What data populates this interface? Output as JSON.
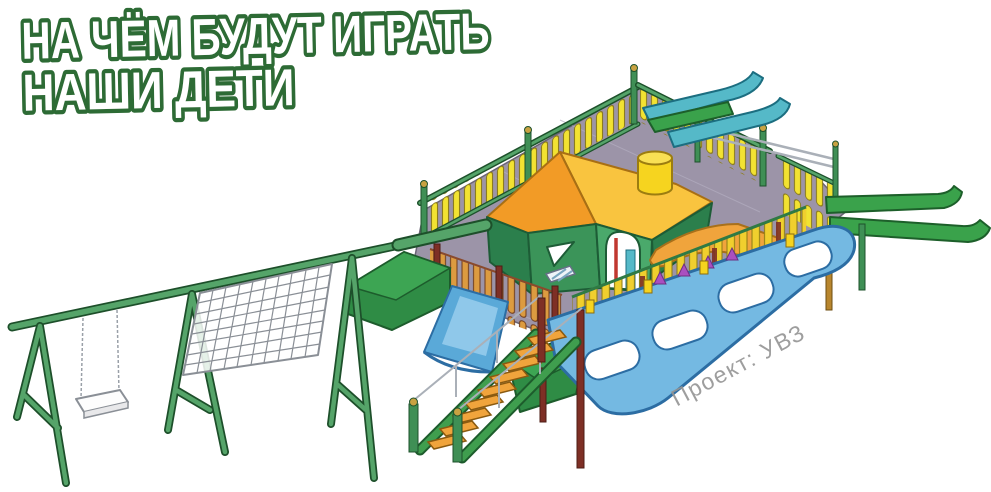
{
  "title": {
    "line1": "НА ЧЁМ БУДУТ ИГРАТЬ",
    "line2": "НАШИ ДЕТИ"
  },
  "watermark": {
    "text": "Проект: УВЗ"
  },
  "illustration": {
    "alt": "3D render of a tank-shaped playground",
    "elements": [
      "swing-set",
      "swing-seat",
      "climbing-net",
      "barrel-beam",
      "turret-playhouse",
      "turret-roof",
      "turret-cupola",
      "picket-fences",
      "rear-slides",
      "track-slides",
      "front-slide",
      "staircase",
      "hull-skirt",
      "deck"
    ]
  },
  "colors": {
    "title_green": "#2d6b35",
    "watermark_gray": "#949494",
    "frame_green": "#55a469",
    "frame_dark": "#1d4f2a",
    "slide_green": "#3aa24b",
    "slide_teal": "#55b9c8",
    "deck_gray": "#9c94a8",
    "roof_dark": "#f29b26",
    "roof_light": "#f9c43f",
    "wall_dark": "#2b7f4c",
    "wall_mid": "#3b9459",
    "wall_light": "#4aa96b",
    "cupola_yellow": "#f6d41f",
    "picket_yellow": "#f2e232",
    "picket_gold": "#f0cf2e",
    "picket_orange": "#dc9b40",
    "post_maroon": "#7e2f25",
    "skirt_blue": "#74b9e2",
    "skirt_outline": "#2c6da3",
    "step_orange": "#f0a43c",
    "purple": "#aa4fc0",
    "rail_gray": "#aab0b8"
  }
}
